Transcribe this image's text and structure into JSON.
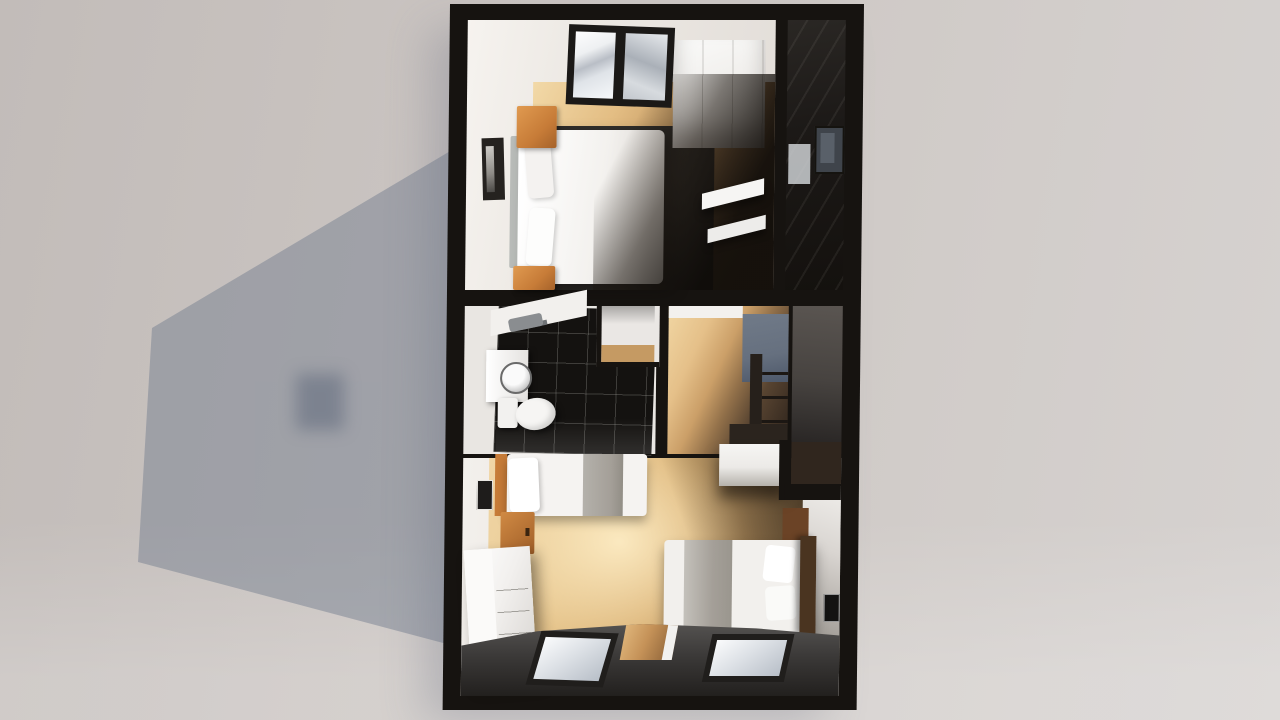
{
  "scene": {
    "kind": "3d-floorplan-render",
    "view": "top-down dollhouse view of an upper floor",
    "background": "light gray studio backdrop with soft cast building shadow"
  },
  "colors": {
    "backdrop": "#cac4c1",
    "shadow": "#707b8d",
    "wall": "#161310",
    "room-white": "#efece8",
    "wood": "#c59a63",
    "rug": "#2c2a27",
    "bed-white": "#f4f2f0",
    "blanket": "#a49f98",
    "orange": "#c77c38",
    "tile": "#141210",
    "stair-blue": "#66707f",
    "band": "#3b3938",
    "glass": "#dde1e6",
    "headboard": "#4a3420"
  },
  "rooms": [
    {
      "id": "bedroom-top",
      "furniture": [
        "double-bed",
        "pillows",
        "gray-headboard",
        "nightstand",
        "nightstand",
        "wardrobe",
        "skylight-window",
        "picture-frame",
        "wall-shelves",
        "dark-rug"
      ]
    },
    {
      "id": "stairwell-top-right",
      "furniture": [
        "picture-frame",
        "storage-box"
      ]
    },
    {
      "id": "bathroom",
      "furniture": [
        "toilet",
        "vanity-sink",
        "round-mirror",
        "shower-fixture",
        "black-floor-tiles"
      ]
    },
    {
      "id": "closet",
      "furniture": []
    },
    {
      "id": "hallway",
      "furniture": [
        "stair-railing",
        "stair-wall"
      ]
    },
    {
      "id": "bedroom-bottom",
      "furniture": [
        "single-bed",
        "single-bed",
        "pillows",
        "dresser",
        "wardrobe",
        "floating-shelf",
        "skylight-window",
        "skylight-window",
        "wood-door",
        "picture-frame",
        "picture-frame"
      ]
    }
  ]
}
